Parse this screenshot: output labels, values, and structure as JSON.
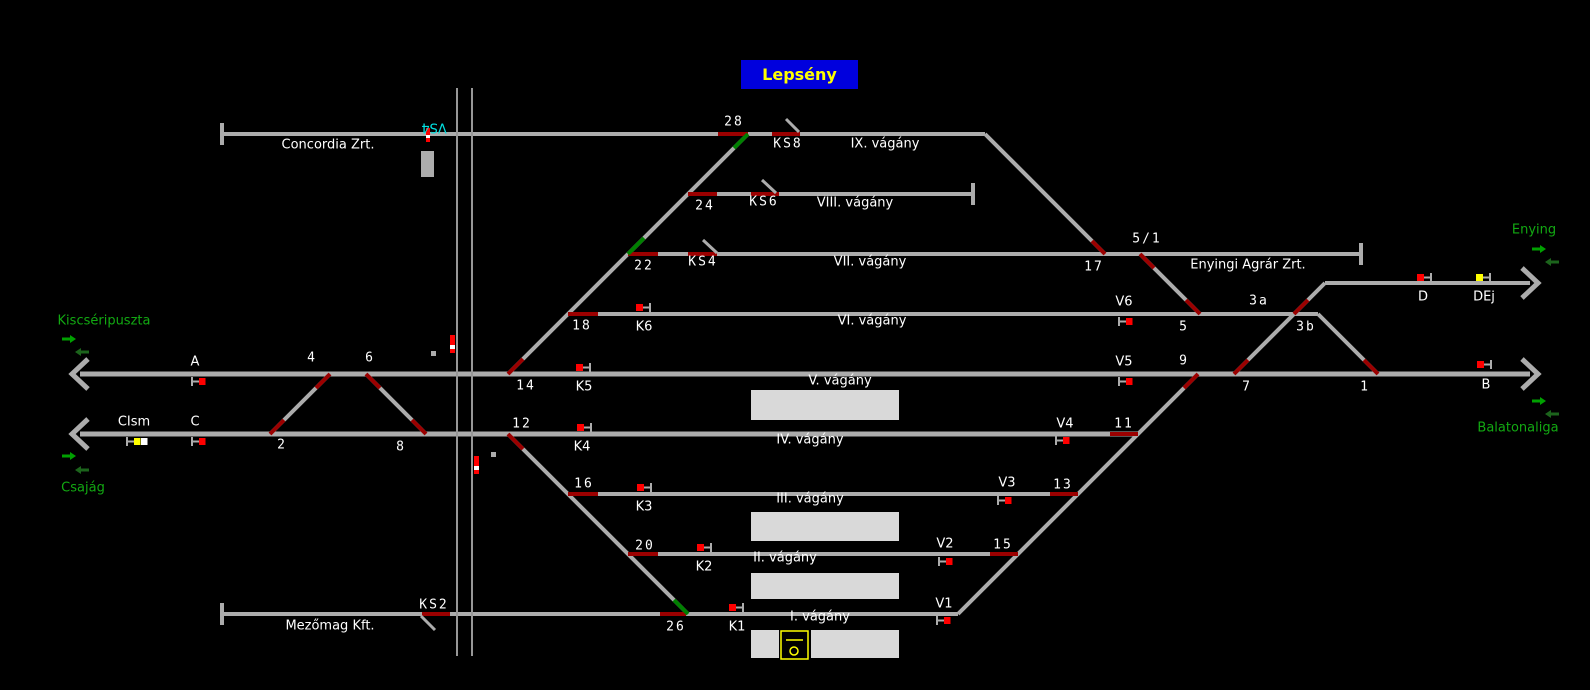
{
  "title": {
    "text": "Lepsény",
    "bg": "#0000DD",
    "fg": "#FFFF00"
  },
  "colors": {
    "background": "#000000",
    "track": "#ACACAC",
    "platform": "#D9D9D9",
    "switch_red": "#9B0000",
    "route_green": "#008000",
    "signal_red": "#FF0000",
    "signal_yellow": "#FFFF00",
    "signal_white": "#FFFFFF",
    "label_white": "#FFFFFF",
    "station_green": "#12A912",
    "arrow_bright": "#00A000",
    "arrow_dark": "#1C641C",
    "crossing_line": "#979797",
    "cyan": "#00E0E0"
  },
  "diagram": {
    "tracks": [
      {
        "id": "ix-concordia",
        "x1": 222,
        "y1": 134,
        "x2": 985,
        "y2": 134
      },
      {
        "id": "ix-bend",
        "x1": 985,
        "y1": 134,
        "x2": 1105,
        "y2": 254
      },
      {
        "id": "viii",
        "x1": 688,
        "y1": 194,
        "x2": 973,
        "y2": 194
      },
      {
        "id": "vii-enyingi",
        "x1": 628,
        "y1": 254,
        "x2": 1361,
        "y2": 254
      },
      {
        "id": "vi",
        "x1": 568,
        "y1": 314,
        "x2": 1318,
        "y2": 314
      },
      {
        "id": "v-main",
        "x1": 80,
        "y1": 374,
        "x2": 1530,
        "y2": 374,
        "w": 5
      },
      {
        "id": "iv",
        "x1": 80,
        "y1": 434,
        "x2": 1138,
        "y2": 434,
        "w": 5
      },
      {
        "id": "iii",
        "x1": 568,
        "y1": 494,
        "x2": 1078,
        "y2": 494
      },
      {
        "id": "ii",
        "x1": 628,
        "y1": 554,
        "x2": 1018,
        "y2": 554
      },
      {
        "id": "i-mezomag",
        "x1": 222,
        "y1": 614,
        "x2": 958,
        "y2": 614
      },
      {
        "id": "d-track",
        "x1": 1325,
        "y1": 283,
        "x2": 1530,
        "y2": 283
      },
      {
        "id": "fan-up",
        "x1": 508,
        "y1": 374,
        "x2": 748,
        "y2": 134
      },
      {
        "id": "fan-down",
        "x1": 508,
        "y1": 434,
        "x2": 688,
        "y2": 614
      },
      {
        "id": "crossover-2-4",
        "x1": 270,
        "y1": 434,
        "x2": 330,
        "y2": 374
      },
      {
        "id": "crossover-6-8",
        "x1": 366,
        "y1": 374,
        "x2": 426,
        "y2": 434
      },
      {
        "id": "diag-5-1-to-5",
        "x1": 1140,
        "y1": 254,
        "x2": 1200,
        "y2": 314
      },
      {
        "id": "diag-right-ladder",
        "x1": 958,
        "y1": 614,
        "x2": 1198,
        "y2": 374
      },
      {
        "id": "diag-7-to-d",
        "x1": 1234,
        "y1": 374,
        "x2": 1325,
        "y2": 283
      },
      {
        "id": "diag-3b-to-1",
        "x1": 1318,
        "y1": 314,
        "x2": 1378,
        "y2": 374
      }
    ],
    "switch_segments": [
      {
        "id": "28",
        "x1": 718,
        "y1": 134,
        "x2": 748,
        "y2": 134
      },
      {
        "id": "ks8",
        "x1": 772,
        "y1": 134,
        "x2": 800,
        "y2": 134
      },
      {
        "id": "24",
        "x1": 688,
        "y1": 194,
        "x2": 717,
        "y2": 194
      },
      {
        "id": "ks6",
        "x1": 751,
        "y1": 194,
        "x2": 779,
        "y2": 194
      },
      {
        "id": "22",
        "x1": 628,
        "y1": 254,
        "x2": 658,
        "y2": 254
      },
      {
        "id": "ks4",
        "x1": 688,
        "y1": 254,
        "x2": 717,
        "y2": 254
      },
      {
        "id": "18",
        "x1": 568,
        "y1": 314,
        "x2": 598,
        "y2": 314
      },
      {
        "id": "16",
        "x1": 568,
        "y1": 494,
        "x2": 598,
        "y2": 494
      },
      {
        "id": "13",
        "x1": 1050,
        "y1": 494,
        "x2": 1078,
        "y2": 494
      },
      {
        "id": "20",
        "x1": 628,
        "y1": 554,
        "x2": 658,
        "y2": 554
      },
      {
        "id": "15",
        "x1": 990,
        "y1": 554,
        "x2": 1018,
        "y2": 554
      },
      {
        "id": "26",
        "x1": 660,
        "y1": 614,
        "x2": 686,
        "y2": 614
      },
      {
        "id": "ks2",
        "x1": 422,
        "y1": 614,
        "x2": 450,
        "y2": 614
      },
      {
        "id": "11",
        "x1": 1110,
        "y1": 434,
        "x2": 1138,
        "y2": 434
      },
      {
        "id": "14",
        "x1": 508,
        "y1": 374,
        "x2": 523,
        "y2": 359
      },
      {
        "id": "12",
        "x1": 508,
        "y1": 434,
        "x2": 523,
        "y2": 449
      },
      {
        "id": "4",
        "x1": 330,
        "y1": 374,
        "x2": 316,
        "y2": 388
      },
      {
        "id": "2",
        "x1": 270,
        "y1": 434,
        "x2": 284,
        "y2": 420
      },
      {
        "id": "6",
        "x1": 366,
        "y1": 374,
        "x2": 380,
        "y2": 388
      },
      {
        "id": "8",
        "x1": 426,
        "y1": 434,
        "x2": 412,
        "y2": 420
      },
      {
        "id": "17",
        "x1": 1092,
        "y1": 241,
        "x2": 1105,
        "y2": 254
      },
      {
        "id": "5-1",
        "x1": 1140,
        "y1": 254,
        "x2": 1154,
        "y2": 268
      },
      {
        "id": "5",
        "x1": 1186,
        "y1": 300,
        "x2": 1200,
        "y2": 314
      },
      {
        "id": "9",
        "x1": 1184,
        "y1": 388,
        "x2": 1198,
        "y2": 374
      },
      {
        "id": "7",
        "x1": 1234,
        "y1": 374,
        "x2": 1248,
        "y2": 360
      },
      {
        "id": "3a",
        "x1": 1294,
        "y1": 314,
        "x2": 1308,
        "y2": 300
      },
      {
        "id": "1",
        "x1": 1364,
        "y1": 360,
        "x2": 1378,
        "y2": 374
      },
      {
        "id": "route-28",
        "color": "green",
        "x1": 734,
        "y1": 148,
        "x2": 748,
        "y2": 134
      },
      {
        "id": "route-22",
        "color": "green",
        "x1": 628,
        "y1": 254,
        "x2": 644,
        "y2": 238
      },
      {
        "id": "route-26",
        "color": "green",
        "x1": 674,
        "y1": 600,
        "x2": 688,
        "y2": 614
      }
    ],
    "ks_ticks": [
      {
        "id": "ks8",
        "x1": 786,
        "y1": 119,
        "x2": 799,
        "y2": 132
      },
      {
        "id": "ks6",
        "x1": 762,
        "y1": 180,
        "x2": 776,
        "y2": 193
      },
      {
        "id": "ks4",
        "x1": 703,
        "y1": 240,
        "x2": 717,
        "y2": 253
      },
      {
        "id": "ks2",
        "x1": 421,
        "y1": 616,
        "x2": 435,
        "y2": 630
      }
    ],
    "bumpers": [
      {
        "id": "concordia",
        "x": 220,
        "y": 123
      },
      {
        "id": "viii",
        "x": 971,
        "y": 183
      },
      {
        "id": "enyingi",
        "x": 1359,
        "y": 243
      },
      {
        "id": "mezomag",
        "x": 220,
        "y": 603
      }
    ],
    "end_arrows": [
      {
        "id": "west-main",
        "x": 72,
        "y": 374,
        "dir": "left"
      },
      {
        "id": "west-iv",
        "x": 72,
        "y": 434,
        "dir": "left"
      },
      {
        "id": "east-d",
        "x": 1538,
        "y": 283,
        "dir": "right"
      },
      {
        "id": "east-main",
        "x": 1538,
        "y": 374,
        "dir": "right"
      }
    ],
    "dir_arrows": [
      {
        "id": "kiscseripuszta-out",
        "x": 62,
        "y": 335,
        "dir": "right",
        "shade": "bright"
      },
      {
        "id": "kiscseripuszta-in",
        "x": 75,
        "y": 348,
        "dir": "left",
        "shade": "dark"
      },
      {
        "id": "csajag-out",
        "x": 62,
        "y": 452,
        "dir": "right",
        "shade": "bright"
      },
      {
        "id": "csajag-in",
        "x": 75,
        "y": 466,
        "dir": "left",
        "shade": "dark"
      },
      {
        "id": "enying-out",
        "x": 1532,
        "y": 245,
        "dir": "right",
        "shade": "bright"
      },
      {
        "id": "enying-in",
        "x": 1545,
        "y": 258,
        "dir": "left",
        "shade": "dark"
      },
      {
        "id": "balatonaliga-out",
        "x": 1532,
        "y": 397,
        "dir": "right",
        "shade": "bright"
      },
      {
        "id": "balatonaliga-in",
        "x": 1545,
        "y": 410,
        "dir": "left",
        "shade": "dark"
      }
    ],
    "platforms": [
      {
        "id": "platform-v-iv",
        "x": 751,
        "y": 390,
        "w": 148,
        "h": 30
      },
      {
        "id": "platform-iii-ii",
        "x": 751,
        "y": 512,
        "w": 148,
        "h": 29
      },
      {
        "id": "platform-ii-i",
        "x": 751,
        "y": 573,
        "w": 148,
        "h": 26
      },
      {
        "id": "platform-i-left",
        "x": 751,
        "y": 630,
        "w": 28,
        "h": 28
      },
      {
        "id": "platform-i-right",
        "x": 811,
        "y": 630,
        "w": 88,
        "h": 28
      }
    ],
    "misc_rects": [
      {
        "id": "loading-ramp",
        "x": 421,
        "y": 151,
        "w": 13,
        "h": 26
      },
      {
        "id": "marker-upper",
        "x": 431,
        "y": 351,
        "w": 5,
        "h": 5
      },
      {
        "id": "marker-lower",
        "x": 491,
        "y": 452,
        "w": 5,
        "h": 5
      }
    ],
    "crossing_lines": [
      {
        "id": "road-crossing-west",
        "x": 457,
        "y1": 88,
        "y2": 656
      },
      {
        "id": "road-crossing-east",
        "x": 472,
        "y1": 88,
        "y2": 656
      }
    ],
    "crossing_signals": [
      {
        "id": "crossing-signal-upper",
        "x": 450,
        "y": 335,
        "w": 5,
        "segs": [
          [
            "red",
            10
          ],
          [
            "white",
            4
          ],
          [
            "red",
            4
          ]
        ]
      },
      {
        "id": "crossing-signal-lower",
        "x": 474,
        "y": 456,
        "w": 5,
        "segs": [
          [
            "red",
            10
          ],
          [
            "white",
            4
          ],
          [
            "red",
            4
          ]
        ]
      },
      {
        "id": "crossing-signal-vs4",
        "x": 426,
        "y": 128,
        "w": 4,
        "segs": [
          [
            "red",
            7
          ],
          [
            "white",
            3
          ],
          [
            "red",
            4
          ]
        ]
      }
    ],
    "signals": [
      {
        "id": "A",
        "type": "L",
        "x": 191,
        "y": 378,
        "colors": [
          "red"
        ]
      },
      {
        "id": "C",
        "type": "L",
        "x": 191,
        "y": 438,
        "colors": [
          "red"
        ]
      },
      {
        "id": "CIsm",
        "type": "L",
        "x": 126,
        "y": 438,
        "colors": [
          "yellow",
          "white"
        ]
      },
      {
        "id": "V1",
        "type": "L",
        "x": 936,
        "y": 617,
        "colors": [
          "red"
        ]
      },
      {
        "id": "V2",
        "type": "L",
        "x": 938,
        "y": 558,
        "colors": [
          "red"
        ]
      },
      {
        "id": "V3",
        "type": "L",
        "x": 997,
        "y": 497,
        "colors": [
          "red"
        ]
      },
      {
        "id": "V4",
        "type": "L",
        "x": 1055,
        "y": 437,
        "colors": [
          "red"
        ]
      },
      {
        "id": "V5",
        "type": "L",
        "x": 1118,
        "y": 378,
        "colors": [
          "red"
        ]
      },
      {
        "id": "V6",
        "type": "L",
        "x": 1118,
        "y": 318,
        "colors": [
          "red"
        ]
      },
      {
        "id": "K1",
        "type": "R",
        "x": 729,
        "y": 604,
        "colors": [
          "red"
        ]
      },
      {
        "id": "K2",
        "type": "R",
        "x": 697,
        "y": 544,
        "colors": [
          "red"
        ]
      },
      {
        "id": "K3",
        "type": "R",
        "x": 637,
        "y": 484,
        "colors": [
          "red"
        ]
      },
      {
        "id": "K4",
        "type": "R",
        "x": 577,
        "y": 424,
        "colors": [
          "red"
        ]
      },
      {
        "id": "K5",
        "type": "R",
        "x": 576,
        "y": 364,
        "colors": [
          "red"
        ]
      },
      {
        "id": "K6",
        "type": "R",
        "x": 636,
        "y": 304,
        "colors": [
          "red"
        ]
      },
      {
        "id": "D",
        "type": "R",
        "x": 1417,
        "y": 274,
        "colors": [
          "red"
        ]
      },
      {
        "id": "DEj",
        "type": "R",
        "x": 1476,
        "y": 274,
        "colors": [
          "yellow"
        ]
      },
      {
        "id": "B",
        "type": "R",
        "x": 1477,
        "y": 361,
        "colors": [
          "red"
        ]
      }
    ],
    "labels": [
      {
        "t": "28",
        "x": 734,
        "y": 122,
        "k": "num"
      },
      {
        "t": "24",
        "x": 705,
        "y": 206,
        "k": "num"
      },
      {
        "t": "22",
        "x": 644,
        "y": 266,
        "k": "num"
      },
      {
        "t": "18",
        "x": 582,
        "y": 326,
        "k": "num"
      },
      {
        "t": "14",
        "x": 526,
        "y": 386,
        "k": "num"
      },
      {
        "t": "12",
        "x": 522,
        "y": 424,
        "k": "num"
      },
      {
        "t": "16",
        "x": 584,
        "y": 484,
        "k": "num"
      },
      {
        "t": "20",
        "x": 645,
        "y": 546,
        "k": "num"
      },
      {
        "t": "26",
        "x": 676,
        "y": 627,
        "k": "num"
      },
      {
        "t": "4",
        "x": 312,
        "y": 358,
        "k": "num"
      },
      {
        "t": "6",
        "x": 370,
        "y": 358,
        "k": "num"
      },
      {
        "t": "2",
        "x": 282,
        "y": 445,
        "k": "num"
      },
      {
        "t": "8",
        "x": 401,
        "y": 447,
        "k": "num"
      },
      {
        "t": "17",
        "x": 1094,
        "y": 267,
        "k": "num"
      },
      {
        "t": "5/1",
        "x": 1147,
        "y": 239,
        "k": "num"
      },
      {
        "t": "5",
        "x": 1184,
        "y": 327,
        "k": "num"
      },
      {
        "t": "9",
        "x": 1184,
        "y": 361,
        "k": "num"
      },
      {
        "t": "7",
        "x": 1247,
        "y": 387,
        "k": "num"
      },
      {
        "t": "3a",
        "x": 1259,
        "y": 301,
        "k": "num"
      },
      {
        "t": "3b",
        "x": 1306,
        "y": 327,
        "k": "num"
      },
      {
        "t": "1",
        "x": 1365,
        "y": 387,
        "k": "num"
      },
      {
        "t": "11",
        "x": 1124,
        "y": 424,
        "k": "num"
      },
      {
        "t": "13",
        "x": 1063,
        "y": 485,
        "k": "num"
      },
      {
        "t": "15",
        "x": 1003,
        "y": 545,
        "k": "num"
      },
      {
        "t": "KS8",
        "x": 788,
        "y": 144,
        "k": "ks"
      },
      {
        "t": "KS6",
        "x": 764,
        "y": 202,
        "k": "ks"
      },
      {
        "t": "KS4",
        "x": 703,
        "y": 262,
        "k": "ks"
      },
      {
        "t": "KS2",
        "x": 434,
        "y": 605,
        "k": "ks"
      },
      {
        "t": "A",
        "x": 195,
        "y": 362,
        "k": "sig"
      },
      {
        "t": "C",
        "x": 195,
        "y": 422,
        "k": "sig"
      },
      {
        "t": "CIsm",
        "x": 134,
        "y": 422,
        "k": "sig"
      },
      {
        "t": "K1",
        "x": 737,
        "y": 627,
        "k": "sig"
      },
      {
        "t": "K2",
        "x": 704,
        "y": 567,
        "k": "sig"
      },
      {
        "t": "K3",
        "x": 644,
        "y": 507,
        "k": "sig"
      },
      {
        "t": "K4",
        "x": 582,
        "y": 447,
        "k": "sig"
      },
      {
        "t": "K5",
        "x": 584,
        "y": 387,
        "k": "sig"
      },
      {
        "t": "K6",
        "x": 644,
        "y": 327,
        "k": "sig"
      },
      {
        "t": "V1",
        "x": 944,
        "y": 604,
        "k": "sig"
      },
      {
        "t": "V2",
        "x": 945,
        "y": 544,
        "k": "sig"
      },
      {
        "t": "V3",
        "x": 1007,
        "y": 483,
        "k": "sig"
      },
      {
        "t": "V4",
        "x": 1065,
        "y": 424,
        "k": "sig"
      },
      {
        "t": "V5",
        "x": 1124,
        "y": 362,
        "k": "sig"
      },
      {
        "t": "V6",
        "x": 1124,
        "y": 302,
        "k": "sig"
      },
      {
        "t": "D",
        "x": 1423,
        "y": 297,
        "k": "sig"
      },
      {
        "t": "DEj",
        "x": 1484,
        "y": 297,
        "k": "sig"
      },
      {
        "t": "B",
        "x": 1486,
        "y": 385,
        "k": "sig"
      },
      {
        "t": "IX. vágány",
        "x": 885,
        "y": 144,
        "k": "name"
      },
      {
        "t": "VIII. vágány",
        "x": 855,
        "y": 203,
        "k": "name"
      },
      {
        "t": "VII. vágány",
        "x": 870,
        "y": 262,
        "k": "name"
      },
      {
        "t": "VI. vágány",
        "x": 872,
        "y": 321,
        "k": "name"
      },
      {
        "t": "V. vágány",
        "x": 840,
        "y": 381,
        "k": "name"
      },
      {
        "t": "IV. vágány",
        "x": 810,
        "y": 440,
        "k": "name"
      },
      {
        "t": "III. vágány",
        "x": 810,
        "y": 499,
        "k": "name"
      },
      {
        "t": "II. vágány",
        "x": 785,
        "y": 558,
        "k": "name"
      },
      {
        "t": "I. vágány",
        "x": 820,
        "y": 617,
        "k": "name"
      },
      {
        "t": "Concordia Zrt.",
        "x": 328,
        "y": 145,
        "k": "name"
      },
      {
        "t": "Mezőmag Kft.",
        "x": 330,
        "y": 626,
        "k": "name"
      },
      {
        "t": "Enyingi Agrár Zrt.",
        "x": 1248,
        "y": 265,
        "k": "name"
      },
      {
        "t": "Kiscséripuszta",
        "x": 104,
        "y": 321,
        "k": "green"
      },
      {
        "t": "Csajág",
        "x": 83,
        "y": 488,
        "k": "green"
      },
      {
        "t": "Enying",
        "x": 1534,
        "y": 230,
        "k": "green"
      },
      {
        "t": "Balatonaliga",
        "x": 1518,
        "y": 428,
        "k": "green"
      },
      {
        "t": "VS4",
        "x": 434,
        "y": 127,
        "k": "cyan",
        "rot": 180
      }
    ],
    "building": {
      "x": 781,
      "y": 631,
      "w": 27,
      "h": 28,
      "line_y": 640,
      "cx": 794,
      "cy": 651,
      "r": 4
    }
  }
}
